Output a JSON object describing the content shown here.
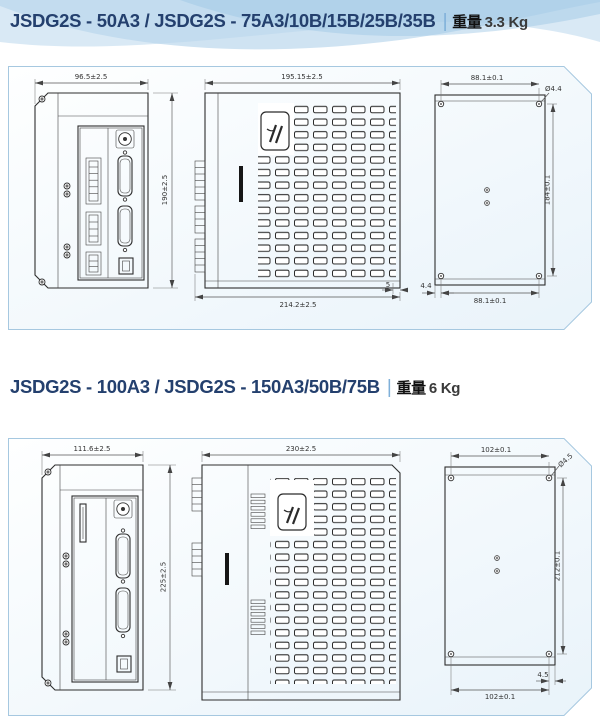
{
  "page": {
    "background": "#ffffff",
    "accent_wave_color": "#bcd8ec",
    "panel_border_color": "#a6c8e0",
    "title_color": "#24406e"
  },
  "sections": [
    {
      "title": "JSDG2S - 50A3 / JSDG2S - 75A3/10B/15B/25B/35B",
      "separator": "|",
      "weight_label": "重量",
      "weight_value": "3.3 Kg",
      "views": {
        "front": {
          "width": "96.5±2.5",
          "height": "190±2.5"
        },
        "side": {
          "depth": "195.15±2.5",
          "overall_depth": "214.2±2.5",
          "lip": "5"
        },
        "back": {
          "hole_span_top": "88.1±0.1",
          "hole_dia": "Ø4.4",
          "hole_span_vertical": "184±0.1",
          "hole_span_bottom": "88.1±0.1",
          "hole_edge_offset": "4.4"
        }
      }
    },
    {
      "title": "JSDG2S - 100A3 / JSDG2S - 150A3/50B/75B",
      "separator": "|",
      "weight_label": "重量",
      "weight_value": "6 Kg",
      "views": {
        "front": {
          "width": "111.6±2.5",
          "height": "225±2.5"
        },
        "side": {
          "depth": "230±2.5"
        },
        "back": {
          "hole_span_top": "102±0.1",
          "hole_dia": "Ø4.5",
          "hole_span_vertical": "212±0.1",
          "hole_span_bottom": "102±0.1",
          "hole_edge_offset": "4.5"
        }
      }
    }
  ]
}
